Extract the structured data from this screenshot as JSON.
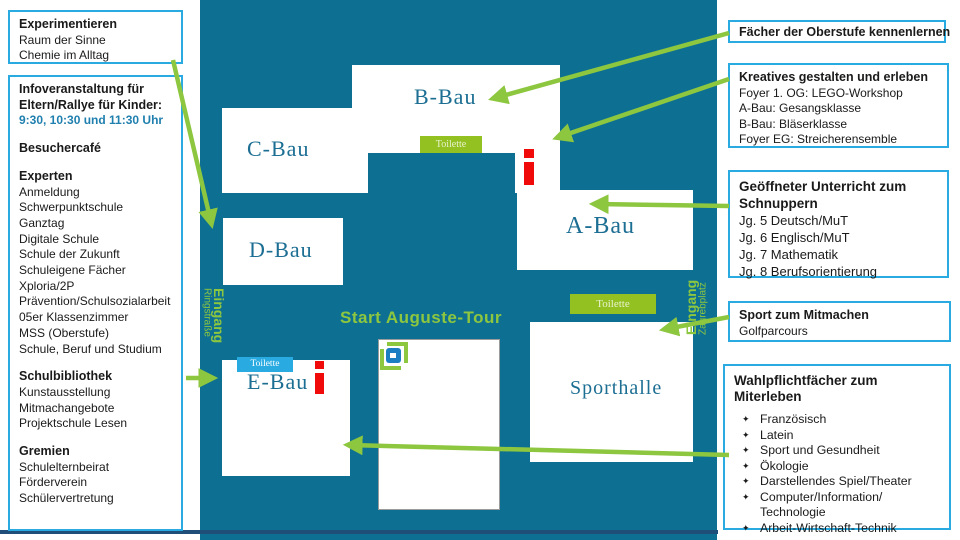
{
  "colors": {
    "map_teal": "#0D7092",
    "accent_green": "#8DC63F",
    "box_border_cyan": "#29ABE2",
    "toilette_green": "#94C122",
    "toilette_blue": "#29ABE2",
    "building_text": "#1C6E93",
    "marker_red": "#F00A0A",
    "times_blue": "#1F7FAE",
    "bottom_line_navy": "#1F4E79"
  },
  "left_panel": {
    "experiment_box": {
      "title": "Experimentieren",
      "items": [
        "Raum der Sinne",
        "Chemie im Alltag"
      ]
    },
    "info_box": {
      "info_title": "Infoveranstaltung für Eltern/Rallye für Kinder:",
      "info_times": "9:30, 10:30 und 11:30 Uhr",
      "cafe": "Besuchercafé",
      "experts_title": "Experten",
      "experts": [
        "Anmeldung",
        "Schwerpunktschule",
        "Ganztag",
        "Digitale Schule",
        "Schule der Zukunft",
        "Schuleigene Fächer",
        "Xploria/2P",
        "Prävention/Schulsozialarbeit",
        "05er Klassenzimmer",
        "MSS (Oberstufe)",
        "Schule, Beruf und Studium"
      ],
      "library_title": "Schulbibliothek",
      "library": [
        "Kunstausstellung",
        "Mitmachangebote",
        "Projektschule Lesen"
      ],
      "committees_title": "Gremien",
      "committees": [
        "Schulelternbeirat",
        "Förderverein",
        "Schülervertretung"
      ]
    }
  },
  "map": {
    "buildings": {
      "a": "A-Bau",
      "b": "B-Bau",
      "c": "C-Bau",
      "d": "D-Bau",
      "e": "E-Bau",
      "sport": "Sporthalle"
    },
    "toilette_label": "Toilette",
    "tour_label": "Start Auguste-Tour",
    "entrance_left": {
      "title": "Eingang",
      "subtitle": "Ringstraße"
    },
    "entrance_right": {
      "title": "Eingang",
      "subtitle": "Zagrebplatz"
    }
  },
  "right_panel": {
    "oberstufe_box": {
      "title": "Fächer der Oberstufe kennenlernen"
    },
    "kreativ_box": {
      "title": "Kreatives gestalten und erleben",
      "items": [
        "Foyer 1. OG: LEGO-Workshop",
        "A-Bau: Gesangsklasse",
        "B-Bau: Bläserklasse",
        "Foyer EG: Streicherensemble"
      ]
    },
    "unterricht_box": {
      "title": "Geöffneter Unterricht zum Schnuppern",
      "items": [
        "Jg. 5 Deutsch/MuT",
        "Jg. 6 Englisch/MuT",
        "Jg. 7 Mathematik",
        "Jg. 8 Berufsorientierung"
      ]
    },
    "sport_box": {
      "title": "Sport zum Mitmachen",
      "items": [
        "Golfparcours"
      ]
    },
    "wahlpflicht_box": {
      "title": "Wahlpflichtfächer zum Miterleben",
      "bullet_char": "✦",
      "items": [
        "Französisch",
        "Latein",
        "Sport und Gesundheit",
        "Ökologie",
        "Darstellendes Spiel/Theater",
        "Computer/Information/ Technologie",
        "Arbeit-Wirtschaft-Technik"
      ]
    }
  }
}
